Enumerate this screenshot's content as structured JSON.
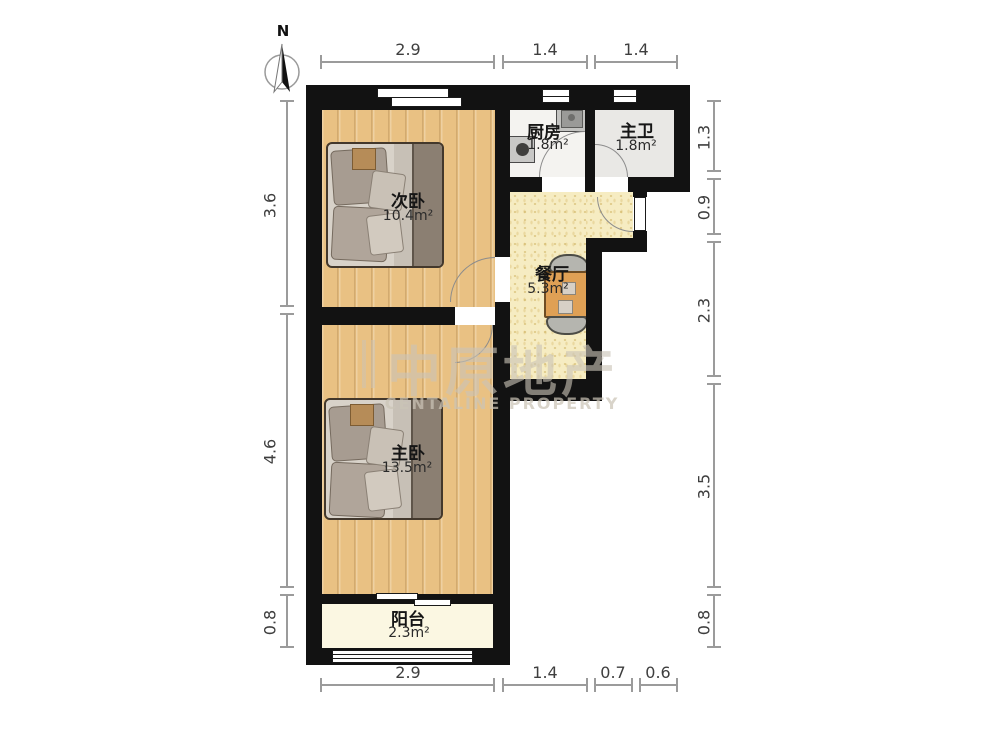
{
  "north": {
    "label": "N"
  },
  "watermark": {
    "zh": "中原地产",
    "en": "CENTALINE PROPERTY"
  },
  "rooms": {
    "secondary_bedroom": {
      "name": "次卧",
      "area": "10.4m²"
    },
    "kitchen": {
      "name": "厨房",
      "area": "1.8m²"
    },
    "master_bathroom": {
      "name": "主卫",
      "area": "1.8m²"
    },
    "dining": {
      "name": "餐厅",
      "area": "5.3m²"
    },
    "master_bedroom": {
      "name": "主卧",
      "area": "13.5m²"
    },
    "balcony": {
      "name": "阳台",
      "area": "2.3m²"
    }
  },
  "dimensions": {
    "top": [
      "2.9",
      "1.4",
      "1.4"
    ],
    "bottom": [
      "2.9",
      "1.4",
      "0.7",
      "0.6"
    ],
    "left": [
      "3.6",
      "4.6",
      "0.8"
    ],
    "right": [
      "1.3",
      "0.9",
      "2.3",
      "3.5",
      "0.8"
    ]
  },
  "colors": {
    "wall": "#121212",
    "wood_floor": "#e9c183",
    "dining_floor": "#f6ecc2",
    "kitchen_floor": "#f4f3f0",
    "bathroom_floor": "#e9e8e5",
    "balcony_floor": "#fbf7e2",
    "dimension_line": "#9b9b9b",
    "watermark": "#cac3b6"
  }
}
